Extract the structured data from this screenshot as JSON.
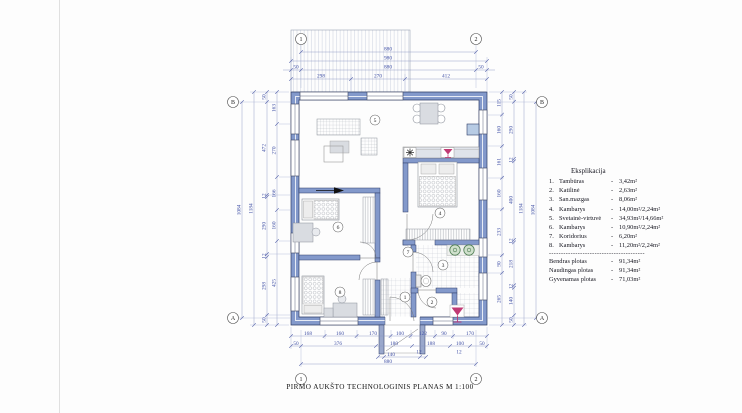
{
  "page": {
    "title": "PIRMO  AUKŠTO  TECHNOLOGINIS PLANAS M 1:100"
  },
  "axis": {
    "col_left": "1",
    "col_right": "2",
    "row_top": "B",
    "row_bottom": "A"
  },
  "rooms": {
    "n1": "1",
    "n2": "2",
    "n3": "3",
    "n4": "4",
    "n5": "5",
    "n6": "6",
    "n7": "7",
    "n8": "8"
  },
  "dims": {
    "top": {
      "r1": "880",
      "r2": "980",
      "r3": [
        "50",
        "880",
        "50"
      ],
      "r4": [
        "298",
        "270",
        "412"
      ]
    },
    "bottom": {
      "r1": [
        "168",
        "160",
        "170",
        "100",
        "122",
        "90",
        "170"
      ],
      "r2": [
        "50",
        "376",
        "180",
        "188",
        "100",
        "50"
      ],
      "r3": [
        "140",
        "12",
        "12"
      ],
      "r4": "880"
    },
    "left": {
      "outer": [
        "50",
        "472",
        "12",
        "290",
        "12",
        "298",
        "50"
      ],
      "inner": [
        "163",
        "270",
        "166",
        "160",
        "425"
      ],
      "total_outer": "1184",
      "total_axis": "1084"
    },
    "right": {
      "outer": [
        "50",
        "290",
        "12",
        "400",
        "12",
        "218",
        "12",
        "140",
        "50"
      ],
      "inner": [
        "115",
        "160",
        "161",
        "160",
        "233",
        "90",
        "265"
      ],
      "total_outer": "1184",
      "total_axis": "1084"
    }
  },
  "legend": {
    "title": "Eksplikacija",
    "dash": "-",
    "items": [
      {
        "num": "1.",
        "name": "Tambūras",
        "area": "3,42m²"
      },
      {
        "num": "2.",
        "name": "Katilinė",
        "area": "2,63m²"
      },
      {
        "num": "3.",
        "name": "San.mazgas",
        "area": "8,06m²"
      },
      {
        "num": "4.",
        "name": "Kambarys",
        "area": "14,00m²/2,24m²"
      },
      {
        "num": "5.",
        "name": "Svetainė-virtuvė",
        "area": "34,93m²/14,66m²"
      },
      {
        "num": "6.",
        "name": "Kambarys",
        "area": "10,90m²/2,24m²"
      },
      {
        "num": "7.",
        "name": "Koridorius",
        "area": "6,20m²"
      },
      {
        "num": "8.",
        "name": "Kambarys",
        "area": "11,20m²/2,24m²"
      }
    ],
    "separator": "---------------------------------------------------------",
    "totals": [
      {
        "name": "Bendras plotas",
        "area": "91,34m²"
      },
      {
        "name": "Naudingas plotas",
        "area": "91,34m²"
      },
      {
        "name": "Gyvenamas plotas",
        "area": "71,03m²"
      }
    ]
  },
  "colors": {
    "wall": "#8399cb",
    "wall_stroke": "#2e3c66",
    "dim": "#3f4fa5",
    "boiler_red": "#c03a74",
    "fixture_green": "#4e7d52"
  }
}
